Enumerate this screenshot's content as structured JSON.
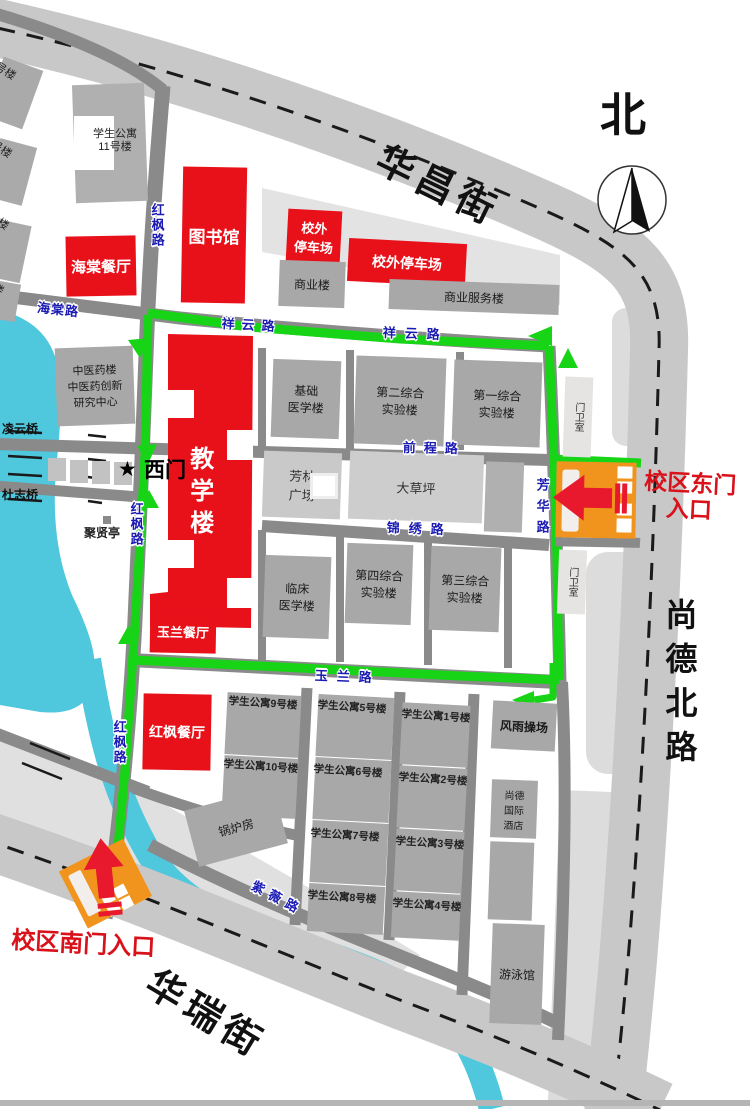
{
  "colors": {
    "building_red": "#e8111a",
    "gate_orange": "#f0941e",
    "route_green": "#17d417",
    "water_cyan": "#4fc7dc",
    "road_gray": "#8a8a8a",
    "street_gray": "#c8c8c8",
    "road_label_blue": "#1b1bb3"
  },
  "t": {
    "north": "北",
    "huachang": "华昌街",
    "shangde": "尚德北路",
    "huarui": "华瑞街",
    "haitang_rd": "海棠路",
    "xiangyun_rd": "祥云路",
    "hongfeng_rd": "红枫路",
    "qiancheng_rd": "前程路",
    "jinxiu_rd": "锦绣路",
    "yulan_rd": "玉兰路",
    "fanghua_rd": "芳华路",
    "ziwei_rd": "紫薇路",
    "lingyun_bridge": "凌云桥",
    "duzhi_bridge": "杜志桥",
    "west_gate_star": "★",
    "west_gate": "西门",
    "east_gate": "校区东门\n入口",
    "south_gate": "校区南门入口",
    "library": "图书馆",
    "haitang_rest": "海棠餐厅",
    "parking_small": "校外\n停车场",
    "parking_wide": "校外停车场",
    "shangye": "商业楼",
    "shangye_fuwu": "商业服务楼",
    "apt11": "学生公寓\n11号楼",
    "apt12": "学生公寓12号楼",
    "apt13": "学生公寓13号楼",
    "apt14": "学生公寓14号楼",
    "apt15": "学生公寓15号楼",
    "zhongyiyao": "中医药楼\n中医药创新\n研究中心",
    "juxianting": "聚贤亭",
    "jiaoxuelou": "教学楼",
    "jichu": "基础\n医学楼",
    "exp2": "第二综合\n实验楼",
    "exp1": "第一综合\n实验楼",
    "fanglin": "芳林\n广场",
    "dacaoping": "大草坪",
    "linchuang": "临床\n医学楼",
    "exp4": "第四综合\n实验楼",
    "exp3": "第三综合\n实验楼",
    "menweishi": "门卫室",
    "yulan_rest": "玉兰餐厅",
    "hongfeng_rest": "红枫餐厅",
    "guolufang": "锅炉房",
    "apt9": "学生公寓9号楼",
    "apt10": "学生公寓10号楼",
    "apt5": "学生公寓5号楼",
    "apt6": "学生公寓6号楼",
    "apt7": "学生公寓7号楼",
    "apt8": "学生公寓8号楼",
    "apt1": "学生公寓1号楼",
    "apt2": "学生公寓2号楼",
    "apt3": "学生公寓3号楼",
    "apt4": "学生公寓4号楼",
    "fengyu": "风雨操场",
    "hotel": "尚德\n国际\n酒店",
    "youyongguan": "游泳馆"
  }
}
